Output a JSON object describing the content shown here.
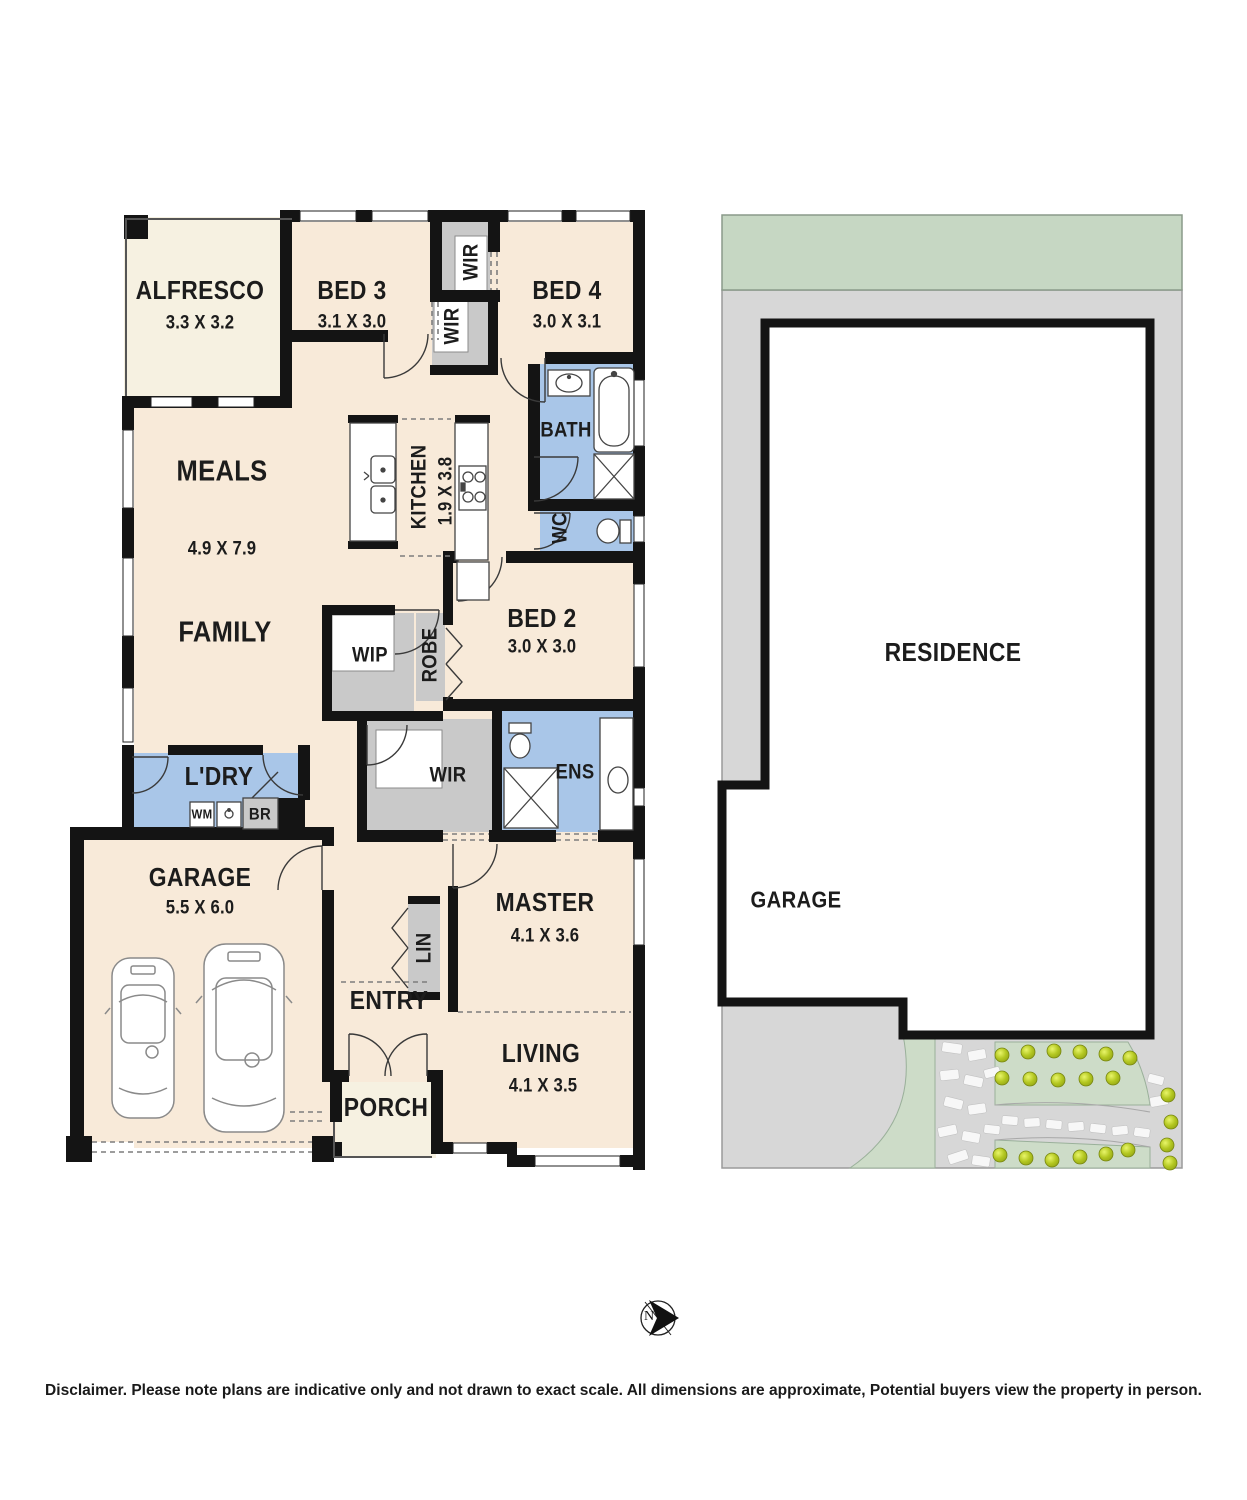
{
  "floor_plan": {
    "rooms": {
      "alfresco": {
        "label": "ALFRESCO",
        "dims": "3.3 X 3.2"
      },
      "bed3": {
        "label": "BED 3",
        "dims": "3.1 X 3.0"
      },
      "bed4": {
        "label": "BED 4",
        "dims": "3.0 X 3.1"
      },
      "wir_bed4": {
        "label": "WIR"
      },
      "wir_bed3": {
        "label": "WIR"
      },
      "bath": {
        "label": "BATH"
      },
      "wc": {
        "label": "WC"
      },
      "kitchen": {
        "label": "KITCHEN",
        "dims": "1.9 X 3.8"
      },
      "meals": {
        "label": "MEALS",
        "dims": "4.9 X 7.9"
      },
      "family": {
        "label": "FAMILY"
      },
      "wip": {
        "label": "WIP"
      },
      "robe": {
        "label": "ROBE"
      },
      "bed2": {
        "label": "BED 2",
        "dims": "3.0 X 3.0"
      },
      "wir_master": {
        "label": "WIR"
      },
      "ens": {
        "label": "ENS"
      },
      "ldry": {
        "label": "L'DRY"
      },
      "wm": {
        "label": "WM"
      },
      "br": {
        "label": "BR"
      },
      "garage": {
        "label": "GARAGE",
        "dims": "5.5 X 6.0"
      },
      "lin": {
        "label": "LIN"
      },
      "master": {
        "label": "MASTER",
        "dims": "4.1 X 3.6"
      },
      "entry": {
        "label": "ENTRY"
      },
      "living": {
        "label": "LIVING",
        "dims": "4.1 X 3.5"
      },
      "porch": {
        "label": "PORCH"
      }
    }
  },
  "site_plan": {
    "residence_label": "RESIDENCE",
    "garage_label": "GARAGE"
  },
  "compass": {
    "north_label": "N"
  },
  "disclaimer": "Disclaimer. Please note plans are indicative only and not drawn to exact scale. All dimensions are approximate, Potential buyers view the property in person.",
  "colors": {
    "floor": "#f8ead9",
    "outdoor_floor": "#f6f1e1",
    "wet_area": "#a9c6e8",
    "closet_gray": "#c9c9c9",
    "wall": "#141414",
    "site_green_strip": "#c6d7c3",
    "landscape_green": "#cddcc8",
    "lot_gray": "#d7d7d7",
    "bush": "#b3c721"
  }
}
